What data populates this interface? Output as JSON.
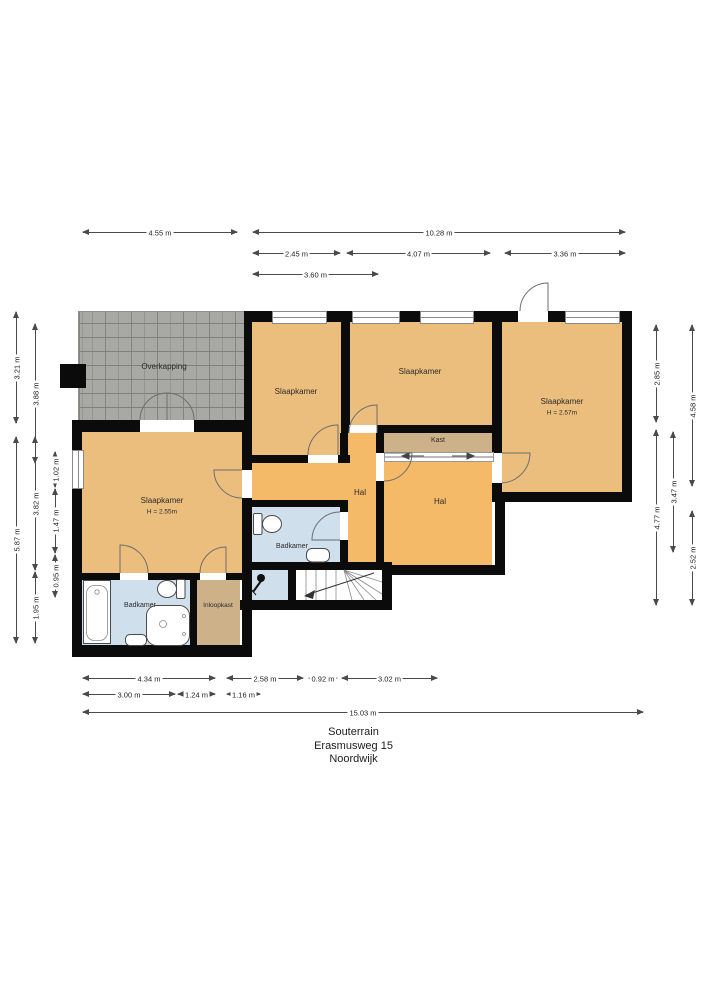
{
  "title": {
    "line1": "Souterrain",
    "line2": "Erasmusweg 15",
    "line3": "Noordwijk"
  },
  "rooms": {
    "overkapping": {
      "label": "Overkapping"
    },
    "slaapkamer_top_left": {
      "label": "Slaapkamer"
    },
    "slaapkamer_top_mid": {
      "label": "Slaapkamer"
    },
    "slaapkamer_right": {
      "label": "Slaapkamer",
      "height": "H = 2.57m"
    },
    "slaapkamer_main": {
      "label": "Slaapkamer",
      "height": "H = 2.55m"
    },
    "kast": {
      "label": "Kast"
    },
    "hal_west": {
      "label": "Hal"
    },
    "hal_east": {
      "label": "Hal"
    },
    "badkamer_mid": {
      "label": "Badkamer"
    },
    "badkamer_sw": {
      "label": "Badkamer"
    },
    "inloopkast": {
      "label": "Inloopkast"
    }
  },
  "colors": {
    "wall": "#0b0b0b",
    "bedroom_floor": "#ecbe7d",
    "hall_floor": "#f5ba67",
    "closet_floor": "#cdb189",
    "bathroom_floor": "#cfdfec",
    "terrace_paving": "#a8a8a4",
    "dimension_line": "#4a4a4a",
    "background": "#ffffff"
  },
  "dimensions": [
    {
      "edge": "top",
      "orientation": "h",
      "x": 83,
      "y": 232,
      "length": 154,
      "label": "4.55 m"
    },
    {
      "edge": "top",
      "orientation": "h",
      "x": 253,
      "y": 232,
      "length": 372,
      "label": "10.28 m"
    },
    {
      "edge": "top",
      "orientation": "h",
      "x": 253,
      "y": 253,
      "length": 87,
      "label": "2.45 m"
    },
    {
      "edge": "top",
      "orientation": "h",
      "x": 347,
      "y": 253,
      "length": 143,
      "label": "4.07 m"
    },
    {
      "edge": "top",
      "orientation": "h",
      "x": 505,
      "y": 253,
      "length": 120,
      "label": "3.36 m"
    },
    {
      "edge": "top",
      "orientation": "h",
      "x": 253,
      "y": 274,
      "length": 125,
      "label": "3.60 m"
    },
    {
      "edge": "left",
      "orientation": "v",
      "x": 16,
      "y": 312,
      "length": 111,
      "label": "3.21 m"
    },
    {
      "edge": "left",
      "orientation": "v",
      "x": 35,
      "y": 324,
      "length": 139,
      "label": "3.88 m"
    },
    {
      "edge": "left",
      "orientation": "v",
      "x": 16,
      "y": 437,
      "length": 206,
      "label": "5.87 m"
    },
    {
      "edge": "left",
      "orientation": "v",
      "x": 35,
      "y": 437,
      "length": 133,
      "label": "3.82 m"
    },
    {
      "edge": "left",
      "orientation": "v",
      "x": 35,
      "y": 572,
      "length": 71,
      "label": "1.95 m"
    },
    {
      "edge": "left",
      "orientation": "v",
      "x": 55,
      "y": 452,
      "length": 35,
      "label": "1.02 m"
    },
    {
      "edge": "left",
      "orientation": "v",
      "x": 55,
      "y": 489,
      "length": 64,
      "label": "1.47 m"
    },
    {
      "edge": "left",
      "orientation": "v",
      "x": 55,
      "y": 555,
      "length": 42,
      "label": "0.95 m"
    },
    {
      "edge": "right",
      "orientation": "v",
      "x": 656,
      "y": 325,
      "length": 97,
      "label": "2.85 m"
    },
    {
      "edge": "right",
      "orientation": "v",
      "x": 656,
      "y": 430,
      "length": 175,
      "label": "4.77 m"
    },
    {
      "edge": "right",
      "orientation": "v",
      "x": 673,
      "y": 432,
      "length": 120,
      "label": "3.47 m"
    },
    {
      "edge": "right",
      "orientation": "v",
      "x": 692,
      "y": 325,
      "length": 161,
      "label": "4.58 m"
    },
    {
      "edge": "right",
      "orientation": "v",
      "x": 692,
      "y": 511,
      "length": 94,
      "label": "2.52 m"
    },
    {
      "edge": "bottom",
      "orientation": "h",
      "x": 83,
      "y": 678,
      "length": 132,
      "label": "4.34 m"
    },
    {
      "edge": "bottom",
      "orientation": "h",
      "x": 227,
      "y": 678,
      "length": 76,
      "label": "2.58 m"
    },
    {
      "edge": "bottom",
      "orientation": "h",
      "x": 309,
      "y": 678,
      "length": 28,
      "label": "0.92 m"
    },
    {
      "edge": "bottom",
      "orientation": "h",
      "x": 342,
      "y": 678,
      "length": 95,
      "label": "3.02 m"
    },
    {
      "edge": "bottom",
      "orientation": "h",
      "x": 83,
      "y": 694,
      "length": 92,
      "label": "3.00 m"
    },
    {
      "edge": "bottom",
      "orientation": "h",
      "x": 178,
      "y": 694,
      "length": 37,
      "label": "1.24 m"
    },
    {
      "edge": "bottom",
      "orientation": "h",
      "x": 227,
      "y": 694,
      "length": 33,
      "label": "1.16 m"
    },
    {
      "edge": "bottom",
      "orientation": "h",
      "x": 83,
      "y": 712,
      "length": 560,
      "label": "15.03 m"
    }
  ]
}
